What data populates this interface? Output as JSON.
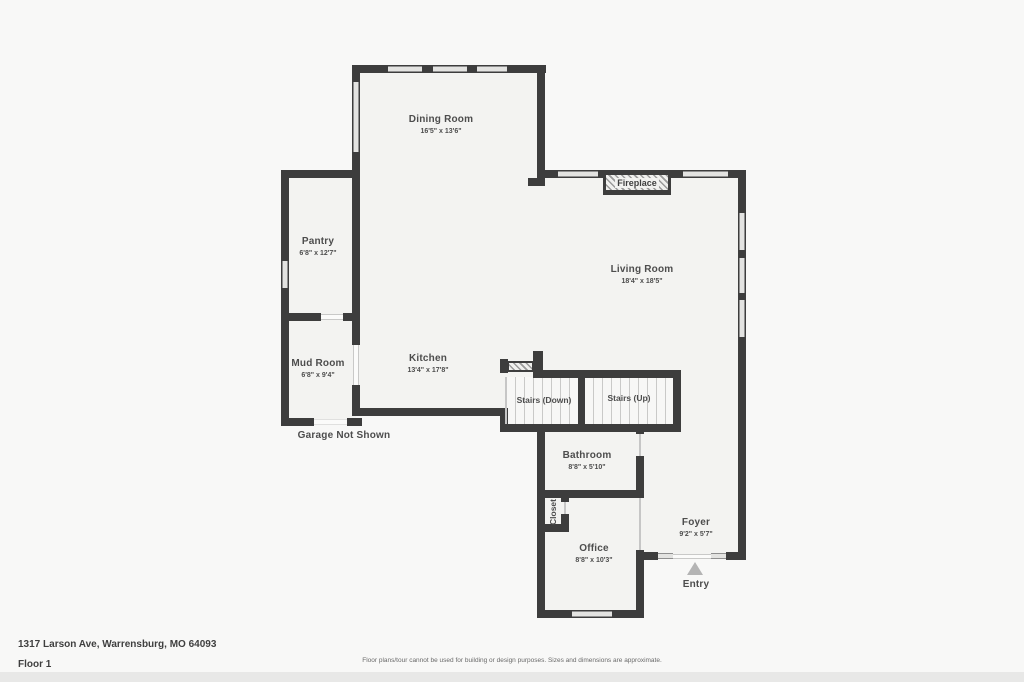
{
  "plan": {
    "rooms": [
      {
        "name": "Dining Room",
        "dims": "16'5\" x 13'6\""
      },
      {
        "name": "Pantry",
        "dims": "6'8\" x 12'7\""
      },
      {
        "name": "Living Room",
        "dims": "18'4\" x 18'5\""
      },
      {
        "name": "Mud Room",
        "dims": "6'8\" x 9'4\""
      },
      {
        "name": "Kitchen",
        "dims": "13'4\" x 17'8\""
      },
      {
        "name": "Stairs (Down)"
      },
      {
        "name": "Stairs (Up)"
      },
      {
        "name": "Bathroom",
        "dims": "8'8\" x 5'10\""
      },
      {
        "name": "Closet"
      },
      {
        "name": "Office",
        "dims": "8'8\" x 10'3\""
      },
      {
        "name": "Foyer",
        "dims": "9'2\" x 5'7\""
      }
    ],
    "fireplace_label": "Fireplace",
    "entry_label": "Entry",
    "garage_note": "Garage Not Shown"
  },
  "footer": {
    "address": "1317 Larson Ave, Warrensburg, MO 64093",
    "floor_label": "Floor 1",
    "disclaimer": "Floor plans/tour cannot be used for building or design purposes. Sizes and dimensions are approximate."
  },
  "colors": {
    "wall": "#3d3d3d",
    "floor_fill": "#f3f3f1",
    "background": "#f8f8f7",
    "window_fill": "#e3e3e1",
    "label_text": "#4d4d4d",
    "entry_arrow": "#b4b4b4"
  }
}
